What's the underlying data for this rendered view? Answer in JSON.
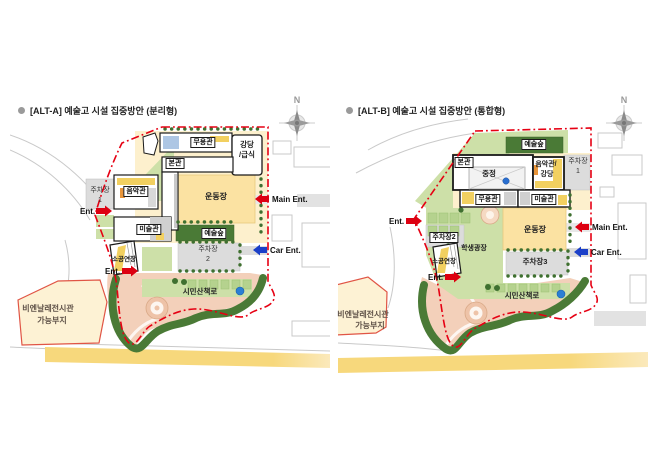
{
  "page": {
    "background": "#ffffff"
  },
  "colors": {
    "boundary_red": "#e60013",
    "entrance_red": "#dd0011",
    "entrance_blue": "#1b3fc8",
    "forest_dark_green": "#4a7a36",
    "site_light_green": "#cde0a8",
    "planter_green": "#b5d28e",
    "field_yellow": "#fbe2a2",
    "road_yellow": "#f7d87c",
    "path_pink": "#f3d0ba",
    "parking_gray": "#dcdcdc",
    "parcel_cream": "#fdf2d4",
    "water_blue": "#2a6fd0"
  },
  "panels": [
    {
      "id": "ALT-A",
      "title": "[ALT-A] 예술고 시설 집중방안 (분리형)",
      "compass": "N",
      "labels": {
        "dance_hall": "무용관",
        "auditorium_l1": "강당",
        "auditorium_l2": "/급식",
        "main_building": "본관",
        "parking1_l1": "주차장",
        "parking1_l2": "1",
        "music_hall": "음악관",
        "sports_field": "운동장",
        "art_hall": "미술관",
        "art_forest": "예술숲",
        "parking2_l1": "주차장",
        "parking2_l2": "2",
        "small_theater": "소공연장",
        "citizen_path": "시민산책로",
        "biennale_l1": "비엔날레전시관",
        "biennale_l2": "가능부지",
        "ent_left": "Ent.",
        "ent_bottom": "Ent.",
        "main_ent": "Main Ent.",
        "car_ent": "Car Ent."
      }
    },
    {
      "id": "ALT-B",
      "title": "[ALT-B] 예술고 시설 집중방안 (통합형)",
      "compass": "N",
      "labels": {
        "art_forest": "예술숲",
        "main_building": "본관",
        "courtyard": "중정",
        "music_auditorium_l1": "음악관/",
        "music_auditorium_l2": "강당",
        "parking1_l1": "주차장",
        "parking1_l2": "1",
        "dance_hall": "무용관",
        "art_hall": "미술관",
        "sports_field": "운동장",
        "parking2": "주차장2",
        "student_plaza": "학생광장",
        "small_theater": "소공연장",
        "parking3": "주차장3",
        "citizen_path": "시민산책로",
        "biennale_l1": "비엔날레전시관",
        "biennale_l2": "가능부지",
        "ent_left": "Ent.",
        "ent_bottom": "Ent.",
        "main_ent": "Main Ent.",
        "car_ent": "Car Ent."
      }
    }
  ]
}
